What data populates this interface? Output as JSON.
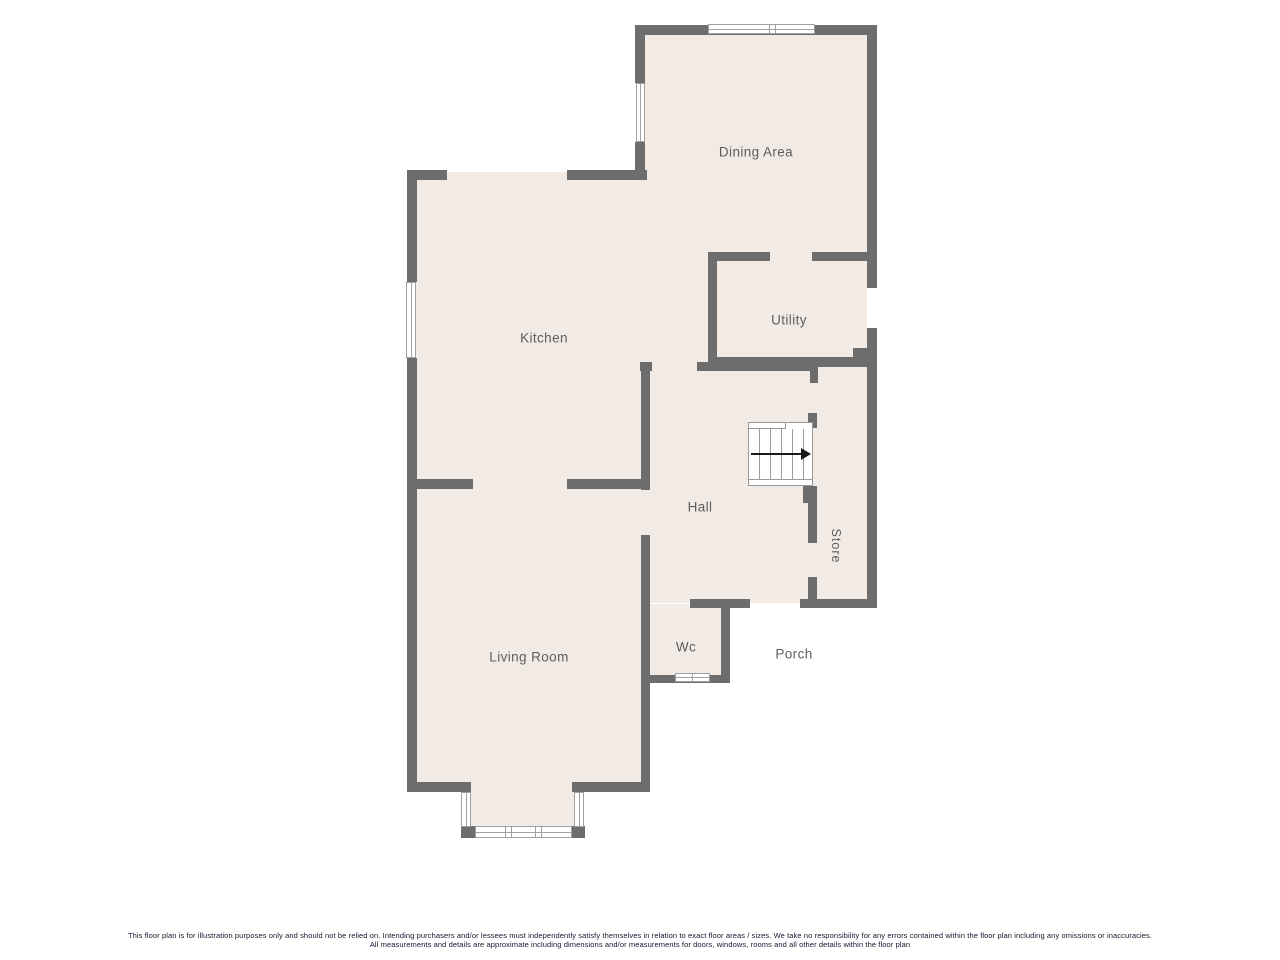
{
  "title": "Ground floor plan",
  "colors": {
    "background": "#ffffff",
    "wall": "#6d6d6d",
    "floor": "#f2ebe5",
    "window_border": "#a0a0a0",
    "stair_line": "#9a9a9a",
    "label": "#5d5d5d",
    "disclaimer_text": "#15152e"
  },
  "rooms": {
    "dining": {
      "label": "Dining Area"
    },
    "kitchen": {
      "label": "Kitchen"
    },
    "utility": {
      "label": "Utility"
    },
    "hall": {
      "label": "Hall"
    },
    "store": {
      "label": "Store"
    },
    "living": {
      "label": "Living Room"
    },
    "wc": {
      "label": "Wc"
    },
    "porch": {
      "label": "Porch"
    }
  },
  "stairs": {
    "direction": "up-to-right"
  },
  "disclaimer": {
    "line1": "This floor plan is for illustration purposes only and should not be relied on. Intending purchasers and/or lessees must independently satisfy themselves in relation to exact floor areas / sizes. We take no responsibility for any errors contained within the floor plan including any omissions or inaccuracies.",
    "line2": "All measurements and details are approximate including dimensions and/or measurements for doors, windows, rooms and all other details within the floor plan"
  }
}
